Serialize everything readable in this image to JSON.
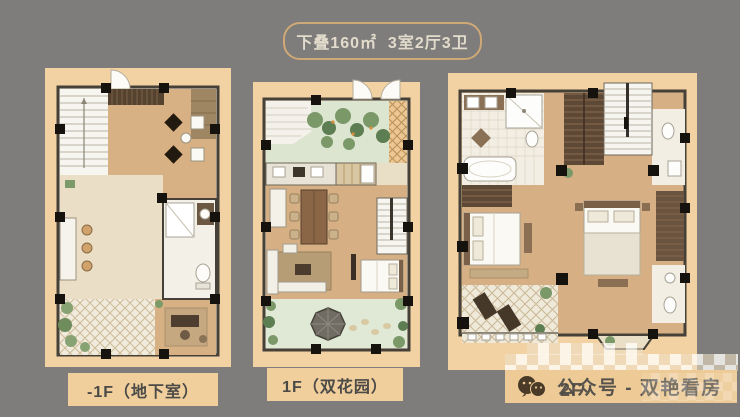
{
  "page": {
    "background": "#7e7d7b"
  },
  "header": {
    "badge_text": "下叠160㎡  3室2厅3卫"
  },
  "plans": [
    {
      "name": "basement",
      "label": "-1F（地下室）"
    },
    {
      "name": "floor1",
      "label": "1F（双花园）"
    },
    {
      "name": "floor2",
      "label": "2F"
    }
  ],
  "watermark": {
    "icon": "wechat-icon",
    "text": "公众号 - 双艳看房"
  },
  "colors": {
    "background_gray": "#7e7d7b",
    "panel_tan": "#f2d2a2",
    "badge_border": "#cfa877",
    "badge_text": "#e3dccd",
    "label_bg": "#f0cf9d",
    "label_text": "#4b4a47",
    "watermark_bar": "#eecb96",
    "watermark_text": "#57524c"
  }
}
